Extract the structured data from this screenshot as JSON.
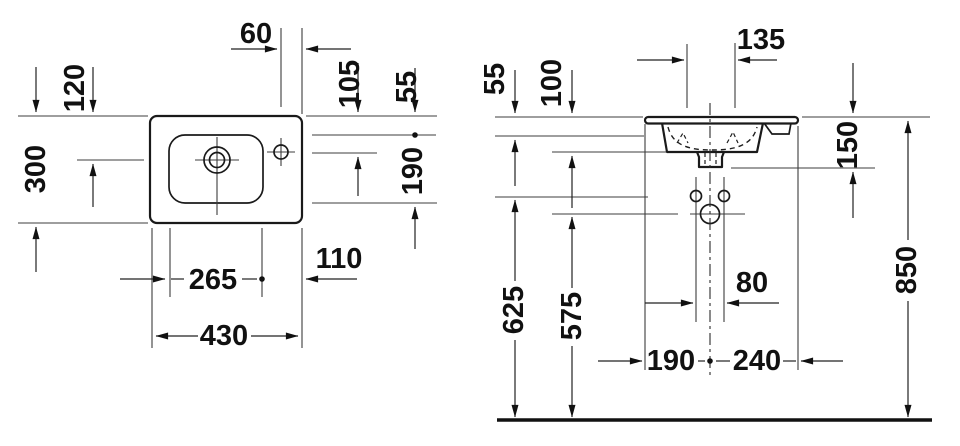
{
  "top_view": {
    "dim_tap_to_right_edge": "60",
    "dim_back_to_drain": "120",
    "dim_total_depth": "300",
    "dim_back_to_tap_center": "105",
    "dim_back_to_bowl": "55",
    "dim_bowl_depth": "190",
    "dim_bowl_width": "265",
    "dim_bowl_to_right_edge": "110",
    "dim_total_width": "430"
  },
  "front_view": {
    "dim_bowl_bottom_width": "135",
    "dim_rim_to_deck_bottom": "55",
    "dim_basin_height": "100",
    "dim_rim_to_drain_fitting": "150",
    "dim_fixing_holes_height": "625",
    "dim_outlet_height": "575",
    "dim_rim_height": "850",
    "dim_fixing_hole_spacing": "80",
    "dim_left_edge_to_centerline": "190",
    "dim_centerline_to_right_edge": "240"
  },
  "colors": {
    "line": "#1a1a1a",
    "background": "#ffffff"
  }
}
